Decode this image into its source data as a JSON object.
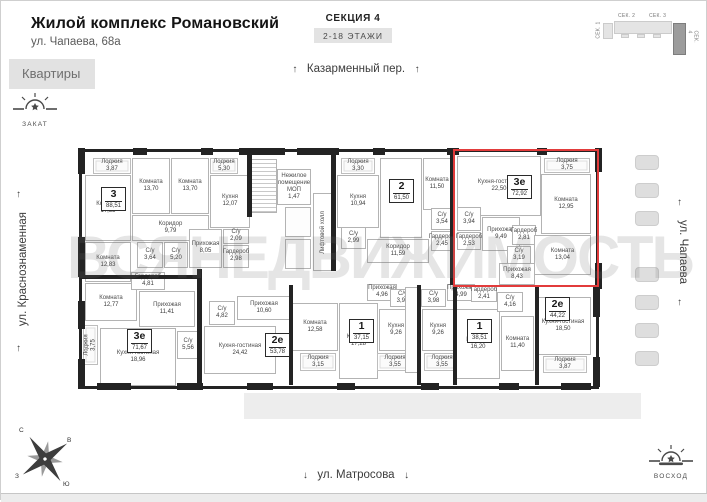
{
  "header": {
    "title": "Жилой комплекс Романовский",
    "address": "ул. Чапаева, 68а",
    "section": "СЕКЦИЯ 4",
    "floors": "2-18 ЭТАЖИ"
  },
  "tabs": {
    "apartments": "Квартиры"
  },
  "minimap": {
    "s1": "СЕК. 1",
    "s2": "СЕК. 2",
    "s3": "СЕК. 3",
    "s4": "СЕК. 4"
  },
  "streets": {
    "top": "Казарменный пер.",
    "left": "ул. Краснознаменная",
    "right": "ул. Чапаева",
    "bottom": "ул. Матросова"
  },
  "sun": {
    "sunset": "ЗАКАТ",
    "sunrise": "ВОСХОД"
  },
  "compass": {
    "n": "С",
    "e": "В",
    "s": "Ю",
    "w": "З"
  },
  "icons": {
    "arrow_up": "↑",
    "arrow_down": "↓"
  },
  "watermark": "ВСЯНЕДВИЖИМОСТЬ",
  "highlight_color": "#e23b3b",
  "plan": {
    "apartments": [
      {
        "num": "3",
        "area": "88,51",
        "x": 100,
        "y": 186,
        "highlighted": false
      },
      {
        "num": "2",
        "area": "61,50",
        "x": 388,
        "y": 178,
        "highlighted": false
      },
      {
        "num": "3е",
        "area": "72,92",
        "x": 506,
        "y": 174,
        "highlighted": true
      },
      {
        "num": "3е",
        "area": "71,67",
        "x": 126,
        "y": 328,
        "highlighted": false
      },
      {
        "num": "2е",
        "area": "53,78",
        "x": 264,
        "y": 332,
        "highlighted": false
      },
      {
        "num": "1",
        "area": "37,15",
        "x": 348,
        "y": 318,
        "highlighted": false
      },
      {
        "num": "1",
        "area": "38,51",
        "x": 466,
        "y": 318,
        "highlighted": false
      },
      {
        "num": "2е",
        "area": "44,22",
        "x": 544,
        "y": 296,
        "highlighted": false
      }
    ],
    "rooms": [
      {
        "n": "Лоджия",
        "a": "3,87",
        "x": 92,
        "y": 157,
        "w": 38,
        "h": 16,
        "k": "l"
      },
      {
        "n": "Комната",
        "a": "13,70",
        "x": 131,
        "y": 157,
        "w": 38,
        "h": 56,
        "k": "r"
      },
      {
        "n": "Комната",
        "a": "13,70",
        "x": 170,
        "y": 157,
        "w": 38,
        "h": 56,
        "k": "r"
      },
      {
        "n": "Лоджия",
        "a": "5,30",
        "x": 209,
        "y": 157,
        "w": 28,
        "h": 16,
        "k": "l"
      },
      {
        "n": "Кухня",
        "a": "12,07",
        "x": 209,
        "y": 174,
        "w": 40,
        "h": 53,
        "k": "r"
      },
      {
        "n": "Комната",
        "a": "17,35",
        "x": 84,
        "y": 174,
        "w": 46,
        "h": 66,
        "k": "r"
      },
      {
        "n": "Коридор",
        "a": "9,79",
        "x": 131,
        "y": 214,
        "w": 77,
        "h": 26,
        "k": "r"
      },
      {
        "n": "С/у",
        "a": "3,64",
        "x": 136,
        "y": 241,
        "w": 26,
        "h": 26,
        "k": "r"
      },
      {
        "n": "С/у",
        "a": "5,20",
        "x": 163,
        "y": 241,
        "w": 24,
        "h": 26,
        "k": "r"
      },
      {
        "n": "Прихожая",
        "a": "8,05",
        "x": 188,
        "y": 228,
        "w": 33,
        "h": 39,
        "k": "r"
      },
      {
        "n": "С/у",
        "a": "2,09",
        "x": 222,
        "y": 228,
        "w": 26,
        "h": 15,
        "k": "r"
      },
      {
        "n": "Гардероб",
        "a": "2,98",
        "x": 222,
        "y": 244,
        "w": 26,
        "h": 23,
        "k": "r"
      },
      {
        "n": "Комната",
        "a": "12,83",
        "x": 84,
        "y": 241,
        "w": 46,
        "h": 40,
        "k": "r"
      },
      {
        "n": "",
        "a": "",
        "x": 250,
        "y": 158,
        "w": 26,
        "h": 54,
        "k": "s"
      },
      {
        "n": "Нежилое помещение МОП",
        "a": "1,47",
        "x": 276,
        "y": 168,
        "w": 34,
        "h": 36,
        "k": "r"
      },
      {
        "n": "Лифтовой холл",
        "a": "",
        "x": 312,
        "y": 192,
        "w": 20,
        "h": 78,
        "k": "v"
      },
      {
        "n": "",
        "a": "",
        "x": 284,
        "y": 206,
        "w": 26,
        "h": 30,
        "k": "sh"
      },
      {
        "n": "",
        "a": "",
        "x": 284,
        "y": 238,
        "w": 26,
        "h": 30,
        "k": "sh"
      },
      {
        "n": "Лоджия",
        "a": "3,30",
        "x": 340,
        "y": 157,
        "w": 34,
        "h": 16,
        "k": "l"
      },
      {
        "n": "Кухня",
        "a": "10,94",
        "x": 336,
        "y": 174,
        "w": 42,
        "h": 53,
        "k": "r"
      },
      {
        "n": "Комната",
        "a": "17,04",
        "x": 379,
        "y": 157,
        "w": 42,
        "h": 80,
        "k": "r"
      },
      {
        "n": "Комната",
        "a": "11,50",
        "x": 422,
        "y": 157,
        "w": 28,
        "h": 52,
        "k": "r"
      },
      {
        "n": "С/у",
        "a": "2,99",
        "x": 340,
        "y": 226,
        "w": 25,
        "h": 22,
        "k": "r"
      },
      {
        "n": "Коридор",
        "a": "11,59",
        "x": 366,
        "y": 238,
        "w": 62,
        "h": 24,
        "k": "r"
      },
      {
        "n": "С/у",
        "a": "3,54",
        "x": 430,
        "y": 207,
        "w": 22,
        "h": 22,
        "k": "r"
      },
      {
        "n": "Гардероб",
        "a": "2,45",
        "x": 430,
        "y": 230,
        "w": 22,
        "h": 20,
        "k": "r"
      },
      {
        "n": "Кухня-гостиная",
        "a": "22,50",
        "x": 456,
        "y": 155,
        "w": 84,
        "h": 60,
        "k": "r"
      },
      {
        "n": "Лоджия",
        "a": "3,75",
        "x": 543,
        "y": 157,
        "w": 46,
        "h": 15,
        "k": "l"
      },
      {
        "n": "Комната",
        "a": "12,95",
        "x": 540,
        "y": 173,
        "w": 50,
        "h": 60,
        "k": "r"
      },
      {
        "n": "С/у",
        "a": "3,94",
        "x": 456,
        "y": 206,
        "w": 24,
        "h": 24,
        "k": "r"
      },
      {
        "n": "Гардероб",
        "a": "2,53",
        "x": 456,
        "y": 231,
        "w": 24,
        "h": 18,
        "k": "r"
      },
      {
        "n": "Прихожая",
        "a": "9,49",
        "x": 481,
        "y": 216,
        "w": 38,
        "h": 34,
        "k": "r"
      },
      {
        "n": "Гардероб",
        "a": "2,81",
        "x": 511,
        "y": 224,
        "w": 24,
        "h": 20,
        "k": "r"
      },
      {
        "n": "С/у",
        "a": "3,19",
        "x": 506,
        "y": 245,
        "w": 24,
        "h": 18,
        "k": "r"
      },
      {
        "n": "Комната",
        "a": "13,04",
        "x": 533,
        "y": 234,
        "w": 57,
        "h": 40,
        "k": "r"
      },
      {
        "n": "Прихожая",
        "a": "8,43",
        "x": 498,
        "y": 262,
        "w": 36,
        "h": 22,
        "k": "r"
      },
      {
        "n": "Комната",
        "a": "12,77",
        "x": 84,
        "y": 282,
        "w": 52,
        "h": 38,
        "k": "r"
      },
      {
        "n": "Гардероб",
        "a": "4,81",
        "x": 130,
        "y": 271,
        "w": 34,
        "h": 18,
        "k": "r"
      },
      {
        "n": "Прихожая",
        "a": "11,41",
        "x": 138,
        "y": 290,
        "w": 56,
        "h": 36,
        "k": "r"
      },
      {
        "n": "Лоджия",
        "a": "3,75",
        "x": 82,
        "y": 324,
        "w": 15,
        "h": 40,
        "k": "vl"
      },
      {
        "n": "Кухня-гостиная",
        "a": "18,96",
        "x": 99,
        "y": 327,
        "w": 76,
        "h": 58,
        "k": "r"
      },
      {
        "n": "С/у",
        "a": "5,56",
        "x": 176,
        "y": 330,
        "w": 22,
        "h": 28,
        "k": "r"
      },
      {
        "n": "С/у",
        "a": "4,82",
        "x": 208,
        "y": 300,
        "w": 26,
        "h": 24,
        "k": "r"
      },
      {
        "n": "Прихожая",
        "a": "10,60",
        "x": 236,
        "y": 295,
        "w": 54,
        "h": 24,
        "k": "r"
      },
      {
        "n": "Кухня-гостиная",
        "a": "24,42",
        "x": 203,
        "y": 325,
        "w": 72,
        "h": 48,
        "k": "r"
      },
      {
        "n": "Комната",
        "a": "12,58",
        "x": 291,
        "y": 302,
        "w": 46,
        "h": 48,
        "k": "r"
      },
      {
        "n": "Лоджия",
        "a": "3,15",
        "x": 299,
        "y": 352,
        "w": 36,
        "h": 18,
        "k": "l"
      },
      {
        "n": "Прихожая",
        "a": "4,96",
        "x": 366,
        "y": 283,
        "w": 30,
        "h": 17,
        "k": "r"
      },
      {
        "n": "С/у",
        "a": "3,98",
        "x": 389,
        "y": 288,
        "w": 25,
        "h": 18,
        "k": "r"
      },
      {
        "n": "Кухня",
        "a": "9,26",
        "x": 378,
        "y": 308,
        "w": 34,
        "h": 42,
        "k": "r"
      },
      {
        "n": "Комната",
        "a": "17,28",
        "x": 338,
        "y": 302,
        "w": 39,
        "h": 76,
        "k": "r"
      },
      {
        "n": "Лоджия",
        "a": "3,55",
        "x": 376,
        "y": 352,
        "w": 36,
        "h": 18,
        "k": "l"
      },
      {
        "n": "",
        "a": "",
        "x": 404,
        "y": 286,
        "w": 14,
        "h": 86,
        "k": "sh"
      },
      {
        "n": "С/у",
        "a": "3,98",
        "x": 420,
        "y": 288,
        "w": 25,
        "h": 18,
        "k": "r"
      },
      {
        "n": "Прихожая",
        "a": "4,99",
        "x": 446,
        "y": 283,
        "w": 28,
        "h": 17,
        "k": "r"
      },
      {
        "n": "Кухня",
        "a": "9,26",
        "x": 421,
        "y": 308,
        "w": 32,
        "h": 42,
        "k": "r"
      },
      {
        "n": "Лоджия",
        "a": "3,55",
        "x": 423,
        "y": 352,
        "w": 36,
        "h": 18,
        "k": "l"
      },
      {
        "n": "Комната",
        "a": "16,20",
        "x": 455,
        "y": 308,
        "w": 44,
        "h": 70,
        "k": "r"
      },
      {
        "n": "Гардероб",
        "a": "2,41",
        "x": 470,
        "y": 285,
        "w": 26,
        "h": 16,
        "k": "r"
      },
      {
        "n": "С/у",
        "a": "4,16",
        "x": 496,
        "y": 291,
        "w": 26,
        "h": 20,
        "k": "r"
      },
      {
        "n": "Комната",
        "a": "11,40",
        "x": 500,
        "y": 315,
        "w": 33,
        "h": 55,
        "k": "r"
      },
      {
        "n": "Кухня-гостиная",
        "a": "18,50",
        "x": 534,
        "y": 296,
        "w": 56,
        "h": 58,
        "k": "r"
      },
      {
        "n": "Лоджия",
        "a": "3,87",
        "x": 542,
        "y": 355,
        "w": 44,
        "h": 17,
        "k": "l"
      }
    ],
    "walls": [
      {
        "x": 132,
        "y": 147,
        "w": 14,
        "h": 7
      },
      {
        "x": 200,
        "y": 147,
        "w": 12,
        "h": 7
      },
      {
        "x": 238,
        "y": 147,
        "w": 46,
        "h": 7
      },
      {
        "x": 296,
        "y": 147,
        "w": 42,
        "h": 7
      },
      {
        "x": 372,
        "y": 147,
        "w": 12,
        "h": 7
      },
      {
        "x": 446,
        "y": 147,
        "w": 12,
        "h": 7
      },
      {
        "x": 536,
        "y": 147,
        "w": 10,
        "h": 7
      },
      {
        "x": 77,
        "y": 147,
        "w": 7,
        "h": 26
      },
      {
        "x": 77,
        "y": 236,
        "w": 7,
        "h": 40
      },
      {
        "x": 77,
        "y": 300,
        "w": 7,
        "h": 28
      },
      {
        "x": 77,
        "y": 358,
        "w": 7,
        "h": 30
      },
      {
        "x": 594,
        "y": 147,
        "w": 7,
        "h": 24
      },
      {
        "x": 594,
        "y": 262,
        "w": 7,
        "h": 26
      },
      {
        "x": 592,
        "y": 286,
        "w": 7,
        "h": 30
      },
      {
        "x": 592,
        "y": 356,
        "w": 7,
        "h": 30
      },
      {
        "x": 96,
        "y": 382,
        "w": 34,
        "h": 7
      },
      {
        "x": 176,
        "y": 382,
        "w": 26,
        "h": 7
      },
      {
        "x": 246,
        "y": 382,
        "w": 26,
        "h": 7
      },
      {
        "x": 336,
        "y": 382,
        "w": 18,
        "h": 7
      },
      {
        "x": 420,
        "y": 382,
        "w": 18,
        "h": 7
      },
      {
        "x": 498,
        "y": 382,
        "w": 20,
        "h": 7
      },
      {
        "x": 560,
        "y": 382,
        "w": 30,
        "h": 7
      },
      {
        "x": 246,
        "y": 150,
        "w": 5,
        "h": 66
      },
      {
        "x": 330,
        "y": 150,
        "w": 5,
        "h": 120
      },
      {
        "x": 449,
        "y": 152,
        "w": 4,
        "h": 132
      },
      {
        "x": 196,
        "y": 268,
        "w": 5,
        "h": 118
      },
      {
        "x": 288,
        "y": 284,
        "w": 4,
        "h": 100
      },
      {
        "x": 416,
        "y": 284,
        "w": 4,
        "h": 100
      },
      {
        "x": 452,
        "y": 284,
        "w": 4,
        "h": 100
      },
      {
        "x": 534,
        "y": 284,
        "w": 4,
        "h": 100
      },
      {
        "x": 80,
        "y": 274,
        "w": 118,
        "h": 4
      }
    ],
    "cars_x": 634,
    "cars_y": [
      154,
      182,
      210,
      266,
      294,
      322,
      350
    ]
  }
}
